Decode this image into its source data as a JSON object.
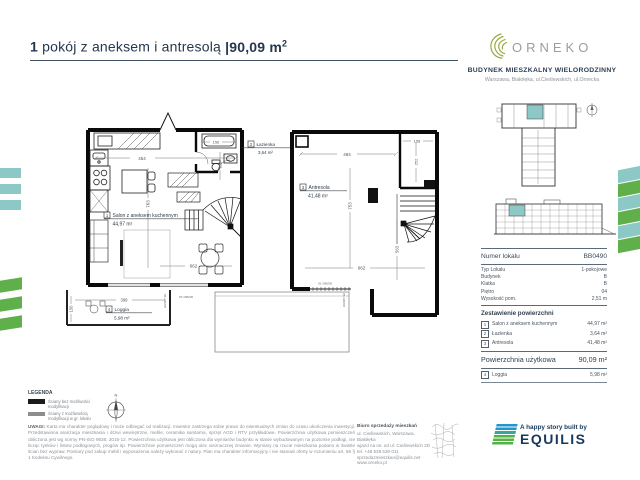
{
  "header": {
    "rooms_num": "1",
    "title": "pokój z aneksem i antresolą",
    "area": "|90,09 m",
    "area_sup": "2"
  },
  "brand": {
    "logo_text": "ORNEKO",
    "building_title": "BUDYNEK MIESZKALNY WIELORODZINNY",
    "building_subtitle": "Warszawa, Białołęka, ul.Cieślewskich, ul.Ornecka"
  },
  "details": {
    "numer_label": "Numer lokalu",
    "numer_value": "BB0490",
    "rows": [
      {
        "label": "Typ Lokalu",
        "value": "1-pokojowe"
      },
      {
        "label": "Budynek",
        "value": "B"
      },
      {
        "label": "Klatka",
        "value": "B"
      },
      {
        "label": "Piętro",
        "value": "04"
      },
      {
        "label": "Wysokość pom.",
        "value": "2,51 m"
      }
    ],
    "areas_header": "Zestawienie powierzchni",
    "areas": [
      {
        "num": "1",
        "label": "Salon z aneksem kuchennym",
        "value": "44,97 m²"
      },
      {
        "num": "2",
        "label": "Łazienka",
        "value": "3,64 m²"
      },
      {
        "num": "3",
        "label": "Antresola",
        "value": "41,48 m²"
      }
    ],
    "total_label": "Powierzchnia użytkowa",
    "total_value": "90,09 m²",
    "loggia_num": "4",
    "loggia_label": "Loggia",
    "loggia_value": "5,98 m²"
  },
  "plan1": {
    "salon_num": "1",
    "salon_label": "Salon z aneksem kuchennym",
    "salon_area": "44,97 m²",
    "bath_num": "2",
    "bath_label": "Łazienka",
    "bath_area": "3,64 m²",
    "loggia_num": "4",
    "loggia_label": "Loggia",
    "loggia_area": "5,98 m²",
    "dims": {
      "width": "454",
      "shaft_w": "156",
      "shaft_h": "252",
      "height": "763",
      "inner_w": "662",
      "loggia_w": "399",
      "loggia_h": "150",
      "tag": "05.39B/0B"
    }
  },
  "plan2": {
    "room_num": "3",
    "room_label": "Antresola",
    "room_area": "41,48 m²",
    "dims": {
      "width": "494",
      "shaft_w": "158",
      "shaft_h": "252",
      "height": "753",
      "right_h": "563",
      "inner_w": "662",
      "tag": "05.39B/0B"
    }
  },
  "legend": {
    "title": "LEGENDA",
    "items": [
      {
        "label": "Ściany bez możliwości modyfikacji"
      },
      {
        "label": "Ściany z możliwością modyfikacji w gr. lokalu"
      }
    ],
    "compass_n": "N"
  },
  "notes": {
    "label": "UWAGI:",
    "text": "Karta ma charakter poglądowy i może odbiegać od realizacji. Inwestor zastrzega sobie prawo do ewentualnych zmian do czasu ukończenia inwestycji. Przedstawiona aranżacja mieszkania i drzwi wewnętrzne, meble, ceramika sanitarna, sprzęt AGD i RTV przykładowe. Powierzchnia użytkowa pomieszczeń obliczona jest wg normy PN-ISO 9836: 2015-12. Powierzchnia użytkowa jest obliczona dla wymiarów budynku w stanie wybudowanym na poziomie podłogi, nie licząc tynków i listew podłogowych, progów itp. Powierzchnie pomieszczeń mogą ulec nieznacznej zmianie. Wymiary na rzucie mieszkania podano w świetle ścian bez wypraw. Pomiary pod zakup mebli i wyposażenia należy wykonać z natury. Plan ma charakter informacyjny i nie stanowi oferty w rozumieniu art. 66 § 1 Kodeksu Cywilnego."
  },
  "office": {
    "title": "Biuro sprzedaży mieszkań",
    "line1": "ul. Cieślewskich, Warszawa, Białołęka",
    "line2": "wjazd na os. od ul. Cieślewskich 2D",
    "line3": "tel. +48 538 530 011",
    "line4": "sprzedazmieszkan@equilis.net",
    "line5": "www.orneko.pl"
  },
  "equilis": {
    "tagline": "A happy story built by",
    "name": "EQUILIS"
  },
  "colors": {
    "accent_teal": "#8bc8c6",
    "accent_green": "#5fb04b",
    "navy": "#24384e",
    "logo_olive": "#9aa93e",
    "equilis_blue": "#2196c9",
    "equilis_green": "#54b345"
  }
}
